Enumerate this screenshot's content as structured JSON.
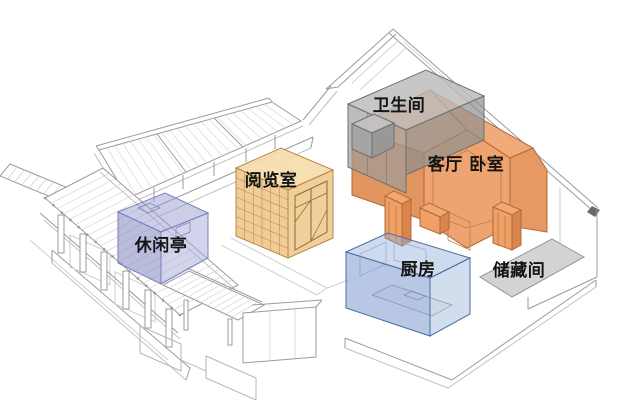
{
  "diagram": {
    "type": "architectural-axonometric",
    "background": "#ffffff"
  },
  "rooms": [
    {
      "id": "pavilion",
      "label": "休闲亭",
      "color": "#8d91c7"
    },
    {
      "id": "reading-room",
      "label": "阅览室",
      "color": "#efc892"
    },
    {
      "id": "bathroom",
      "label": "卫生间",
      "color": "#9c9c9c"
    },
    {
      "id": "living-bedroom",
      "label": "客厅 卧室",
      "color": "#ed9f68"
    },
    {
      "id": "kitchen",
      "label": "厨房",
      "color": "#7d9bcd"
    },
    {
      "id": "storage",
      "label": "储藏间",
      "color": "#cfcfcf"
    }
  ],
  "palette": {
    "wireframe": "#9b9b9b",
    "wireframe_light": "#cfcfcf",
    "label_text": "#141414"
  }
}
